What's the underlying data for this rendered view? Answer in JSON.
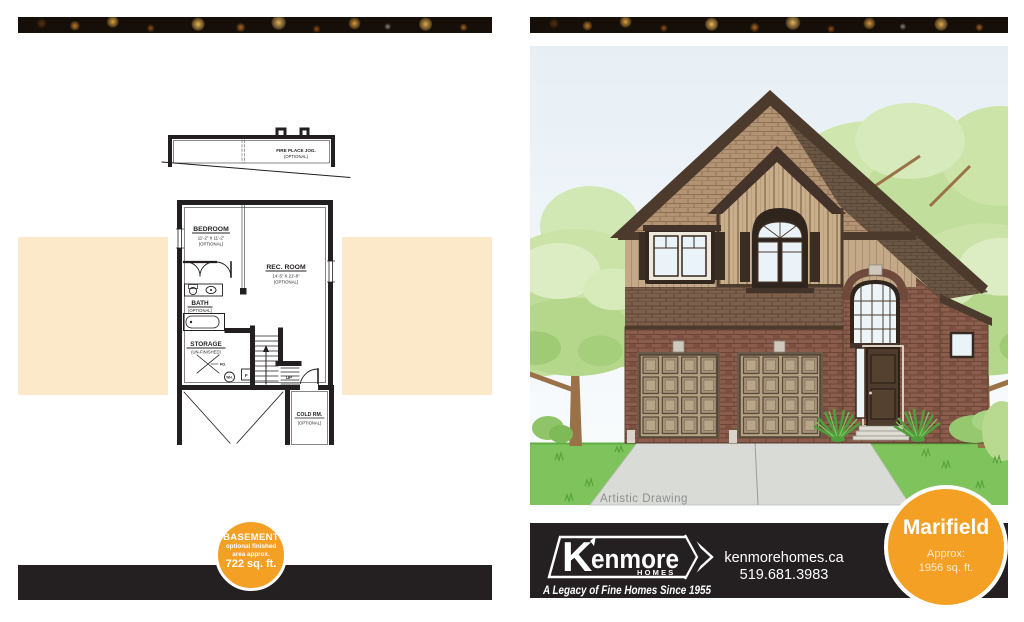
{
  "colors": {
    "orange": "#F4A025",
    "peach": "#FCE9C9",
    "footer_black": "#241F20",
    "plan_ink": "#231F20",
    "grass_green": "#7FC35C",
    "sky": "#EBF2F6",
    "brick": "#8A5D4C",
    "roof_brown": "#4C3A2D"
  },
  "left_page": {
    "floor_plan": {
      "fireplace_label": "FIRE PLACE JOG.",
      "fireplace_optional": "(OPTIONAL)",
      "bedroom_label": "BEDROOM",
      "bedroom_dims": "11'-2\" X 11'-2\"",
      "bedroom_optional": "(OPTIONAL)",
      "rec_room_label": "REC. ROOM",
      "rec_room_dims": "14'-5\" X 21'-8\"",
      "rec_room_optional": "(OPTIONAL)",
      "bath_label": "BATH",
      "bath_optional": "(OPTIONAL)",
      "storage_label": "STORAGE",
      "storage_sub": "(UN-FINISHED)",
      "cold_room_label": "COLD RM.",
      "cold_room_optional": "(OPTIONAL)",
      "unexcavated_label": "UN-EXCAVATED",
      "floor_drain": "FD.",
      "water_heater": "WH.",
      "furnace": "F",
      "stairs_up": "UP"
    },
    "badge": {
      "title": "BASEMENT",
      "line1": "optional finished",
      "line2": "area approx.",
      "value": "722 sq. ft."
    }
  },
  "right_page": {
    "caption": "Artistic Drawing",
    "footer": {
      "brand": "Kenmore",
      "brand_sub": "HOMES",
      "tagline": "A Legacy of Fine Homes Since 1955",
      "website": "kenmorehomes.ca",
      "phone": "519.681.3983"
    },
    "badge": {
      "title": "Marifield",
      "line1": "Approx:",
      "line2": "1956 sq. ft."
    }
  }
}
